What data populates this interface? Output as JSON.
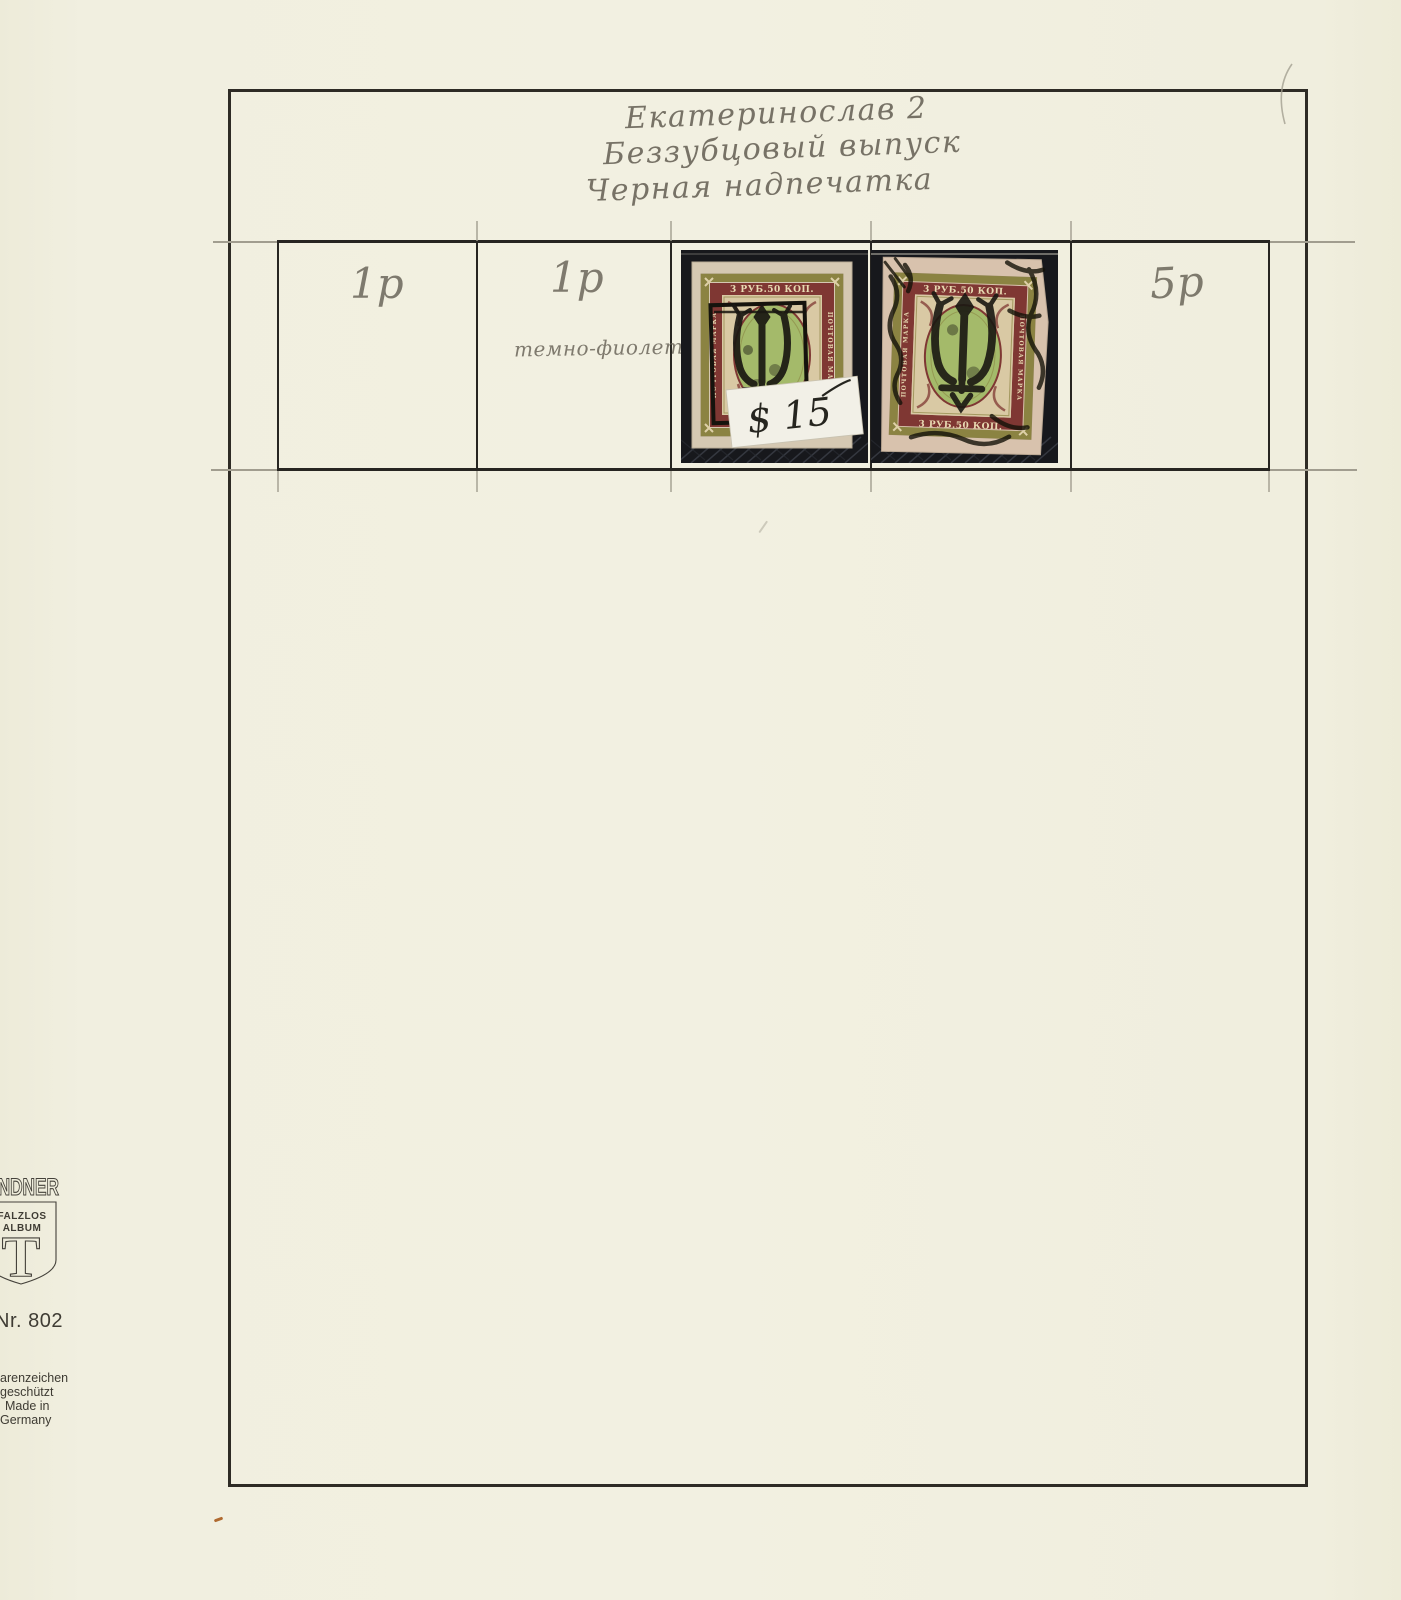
{
  "page": {
    "handwritten_title": [
      "Екатеринослав 2",
      "Беззубцовый выпуск",
      "Черная надпечатка"
    ]
  },
  "table": {
    "cells": [
      {
        "value": "1р",
        "note": ""
      },
      {
        "value": "1р",
        "note": "темно-фиолет"
      },
      {
        "value": "",
        "note": ""
      },
      {
        "value": "",
        "note": ""
      },
      {
        "value": "5р",
        "note": ""
      }
    ]
  },
  "stamps": {
    "denomination": "3 РУБ.50 КОП.",
    "side_inscription": "ПОЧТОВАЯ МАРКА",
    "price_label": "$ 15",
    "overprint": "trident",
    "colors": {
      "mount_black": "#17181c",
      "paper_1": "#d5c8b2",
      "paper_2": "#d8c2ad",
      "olive": "#8b8342",
      "maroon": "#7f3733",
      "center_green": "#a4ba6a",
      "ink": "#1a1812",
      "label_white": "#f2f0e7"
    }
  },
  "publisher": {
    "brand_visible": "INDNER",
    "shield": {
      "line1": "FALZLOS",
      "line2": "ALBUM",
      "letter": "T"
    },
    "catalog_number": "Nr. 802",
    "footer_lines": [
      "arenzeichen",
      "geschützt",
      "Made in",
      "Germany"
    ]
  }
}
